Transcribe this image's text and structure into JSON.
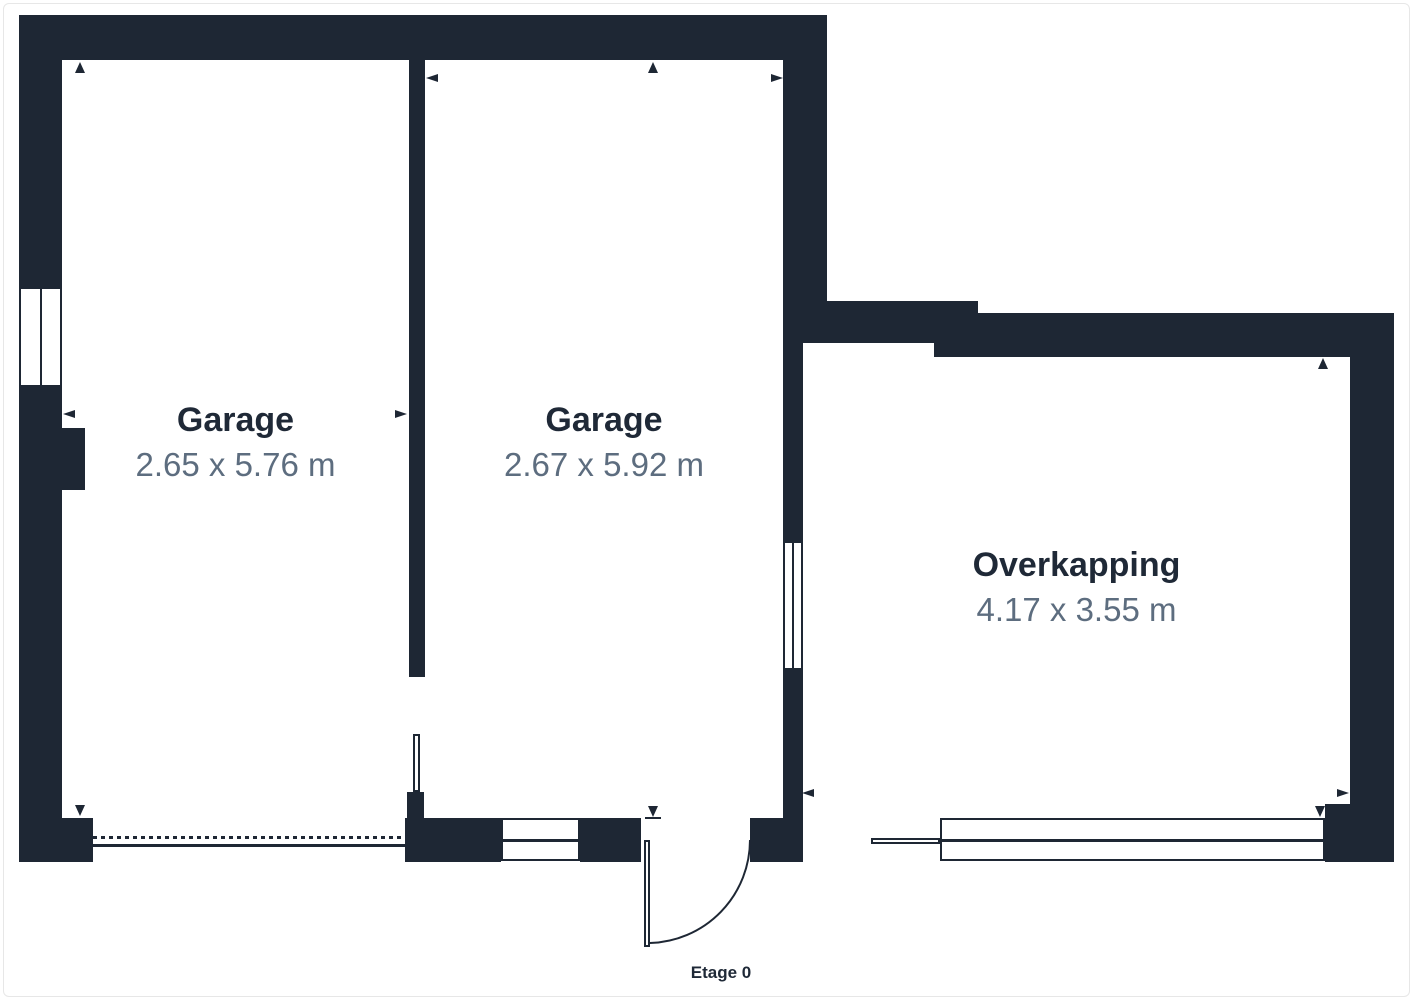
{
  "page": {
    "floor_label": "Etage 0"
  },
  "colors": {
    "wall": "#1e2734",
    "room_name_text": "#1f2937",
    "room_dims_text": "#5d6d7f",
    "background": "#ffffff",
    "canvas_border": "#e7e7e7"
  },
  "rooms": [
    {
      "id": "garage-1",
      "name": "Garage",
      "dims": "2.65 x 5.76 m"
    },
    {
      "id": "garage-2",
      "name": "Garage",
      "dims": "2.67 x 5.92 m"
    },
    {
      "id": "overkapping",
      "name": "Overkapping",
      "dims": "4.17 x 3.55 m"
    }
  ],
  "geometry": {
    "walls": [
      {
        "x": 19,
        "y": 15,
        "w": 808,
        "h": 45
      },
      {
        "x": 19,
        "y": 15,
        "w": 43,
        "h": 272
      },
      {
        "x": 19,
        "y": 387,
        "w": 43,
        "h": 431
      },
      {
        "x": 19,
        "y": 818,
        "w": 74,
        "h": 44
      },
      {
        "x": 62,
        "y": 428,
        "w": 23,
        "h": 62
      },
      {
        "x": 409,
        "y": 60,
        "w": 16,
        "h": 617
      },
      {
        "x": 407,
        "y": 792,
        "w": 17,
        "h": 26
      },
      {
        "x": 405,
        "y": 818,
        "w": 96,
        "h": 44
      },
      {
        "x": 580,
        "y": 818,
        "w": 61,
        "h": 44
      },
      {
        "x": 750,
        "y": 818,
        "w": 53,
        "h": 44
      },
      {
        "x": 783,
        "y": 15,
        "w": 44,
        "h": 328
      },
      {
        "x": 783,
        "y": 343,
        "w": 20,
        "h": 198
      },
      {
        "x": 783,
        "y": 670,
        "w": 20,
        "h": 148
      },
      {
        "x": 802,
        "y": 301,
        "w": 176,
        "h": 42
      },
      {
        "x": 934,
        "y": 313,
        "w": 460,
        "h": 44
      },
      {
        "x": 1350,
        "y": 357,
        "w": 44,
        "h": 447
      },
      {
        "x": 1325,
        "y": 804,
        "w": 69,
        "h": 58
      }
    ],
    "windows": [
      {
        "x": 19,
        "y": 287,
        "w": 43,
        "h": 100,
        "divider": "v"
      },
      {
        "x": 783,
        "y": 541,
        "w": 20,
        "h": 129,
        "divider": "v"
      },
      {
        "x": 501,
        "y": 818,
        "w": 79,
        "h": 43,
        "divider": "h"
      },
      {
        "x": 940,
        "y": 818,
        "w": 385,
        "h": 43,
        "divider": "h"
      }
    ],
    "ledge": {
      "x": 871,
      "y": 838,
      "w": 69,
      "h": 6
    },
    "garage_door": {
      "dashed": {
        "x": 93,
        "y": 836,
        "w": 312
      },
      "solid": {
        "x": 93,
        "y": 844,
        "w": 312
      }
    },
    "door_leaves": [
      {
        "x": 413,
        "y": 734,
        "w": 7,
        "h": 58
      },
      {
        "x": 644,
        "y": 840,
        "w": 6,
        "h": 107
      }
    ],
    "door_arc_path": "M 650 943 A 103 103 0 0 0 750 840",
    "arrows": [
      {
        "x": 75,
        "y": 62,
        "dir": "up"
      },
      {
        "x": 648,
        "y": 62,
        "dir": "up"
      },
      {
        "x": 1318,
        "y": 358,
        "dir": "up"
      },
      {
        "x": 75,
        "y": 805,
        "dir": "down"
      },
      {
        "x": 648,
        "y": 806,
        "dir": "down",
        "underline": {
          "x": 645,
          "y": 817,
          "w": 16,
          "h": 2
        }
      },
      {
        "x": 1315,
        "y": 806,
        "dir": "down"
      },
      {
        "x": 426,
        "y": 74,
        "dir": "left"
      },
      {
        "x": 63,
        "y": 410,
        "dir": "left"
      },
      {
        "x": 802,
        "y": 789,
        "dir": "left"
      },
      {
        "x": 771,
        "y": 74,
        "dir": "right"
      },
      {
        "x": 395,
        "y": 410,
        "dir": "right"
      },
      {
        "x": 1337,
        "y": 789,
        "dir": "right"
      }
    ]
  }
}
